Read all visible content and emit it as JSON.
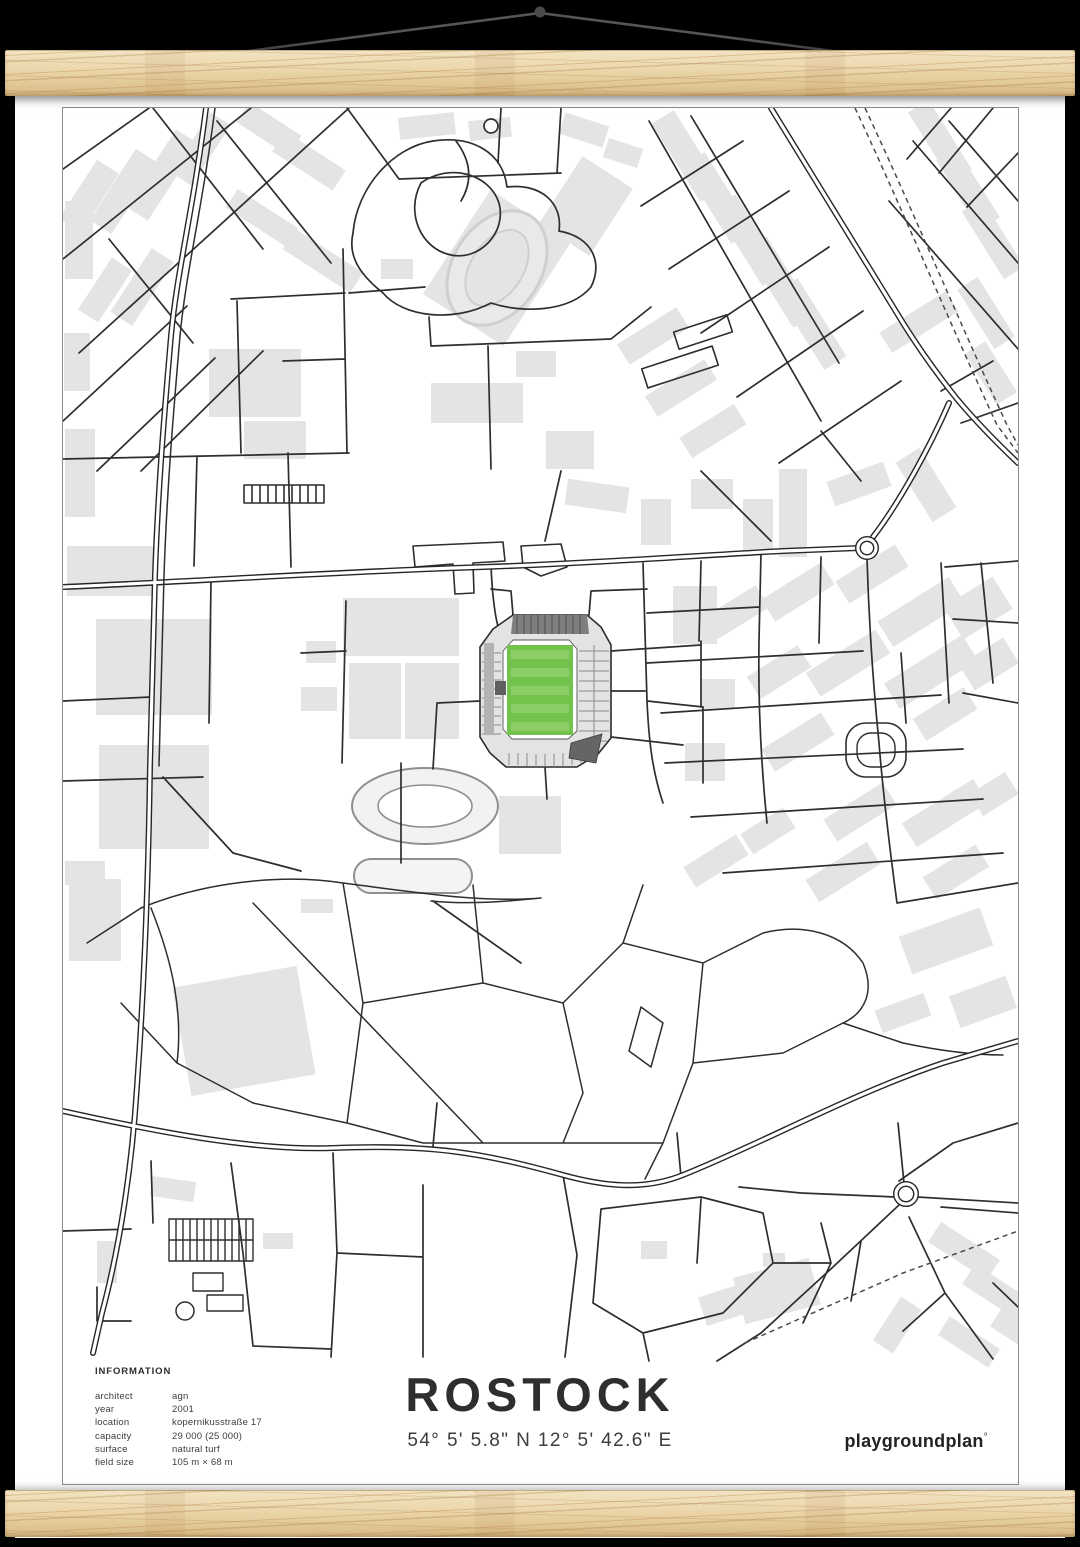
{
  "poster": {
    "title": "ROSTOCK",
    "coordinates": "54° 5' 5.8\" N  12° 5' 42.6\" E",
    "brand": "playgroundplan",
    "brand_mark": "°",
    "info": {
      "heading": "INFORMATION",
      "rows": [
        {
          "label": "architect",
          "value": "agn"
        },
        {
          "label": "year",
          "value": "2001"
        },
        {
          "label": "location",
          "value": "kopernikusstraße 17"
        },
        {
          "label": "capacity",
          "value": "29 000 (25 000)"
        },
        {
          "label": "surface",
          "value": "natural turf"
        },
        {
          "label": "field size",
          "value": "105 m × 68 m"
        }
      ]
    }
  },
  "colors": {
    "background": "#000000",
    "poster": "#ffffff",
    "map_border": "#8c8c8c",
    "road": "#2e2e2e",
    "building_gray": "#e4e4e4",
    "pitch_green": "#72c24b",
    "pitch_green_light": "#8bce66",
    "stand_gray": "#e3e3e3",
    "stand_dark": "#7f7f7f",
    "wedge_dark": "#656565",
    "wood_light": "#f2e3c2",
    "wood_dark": "#d4b681",
    "string": "#565656"
  }
}
